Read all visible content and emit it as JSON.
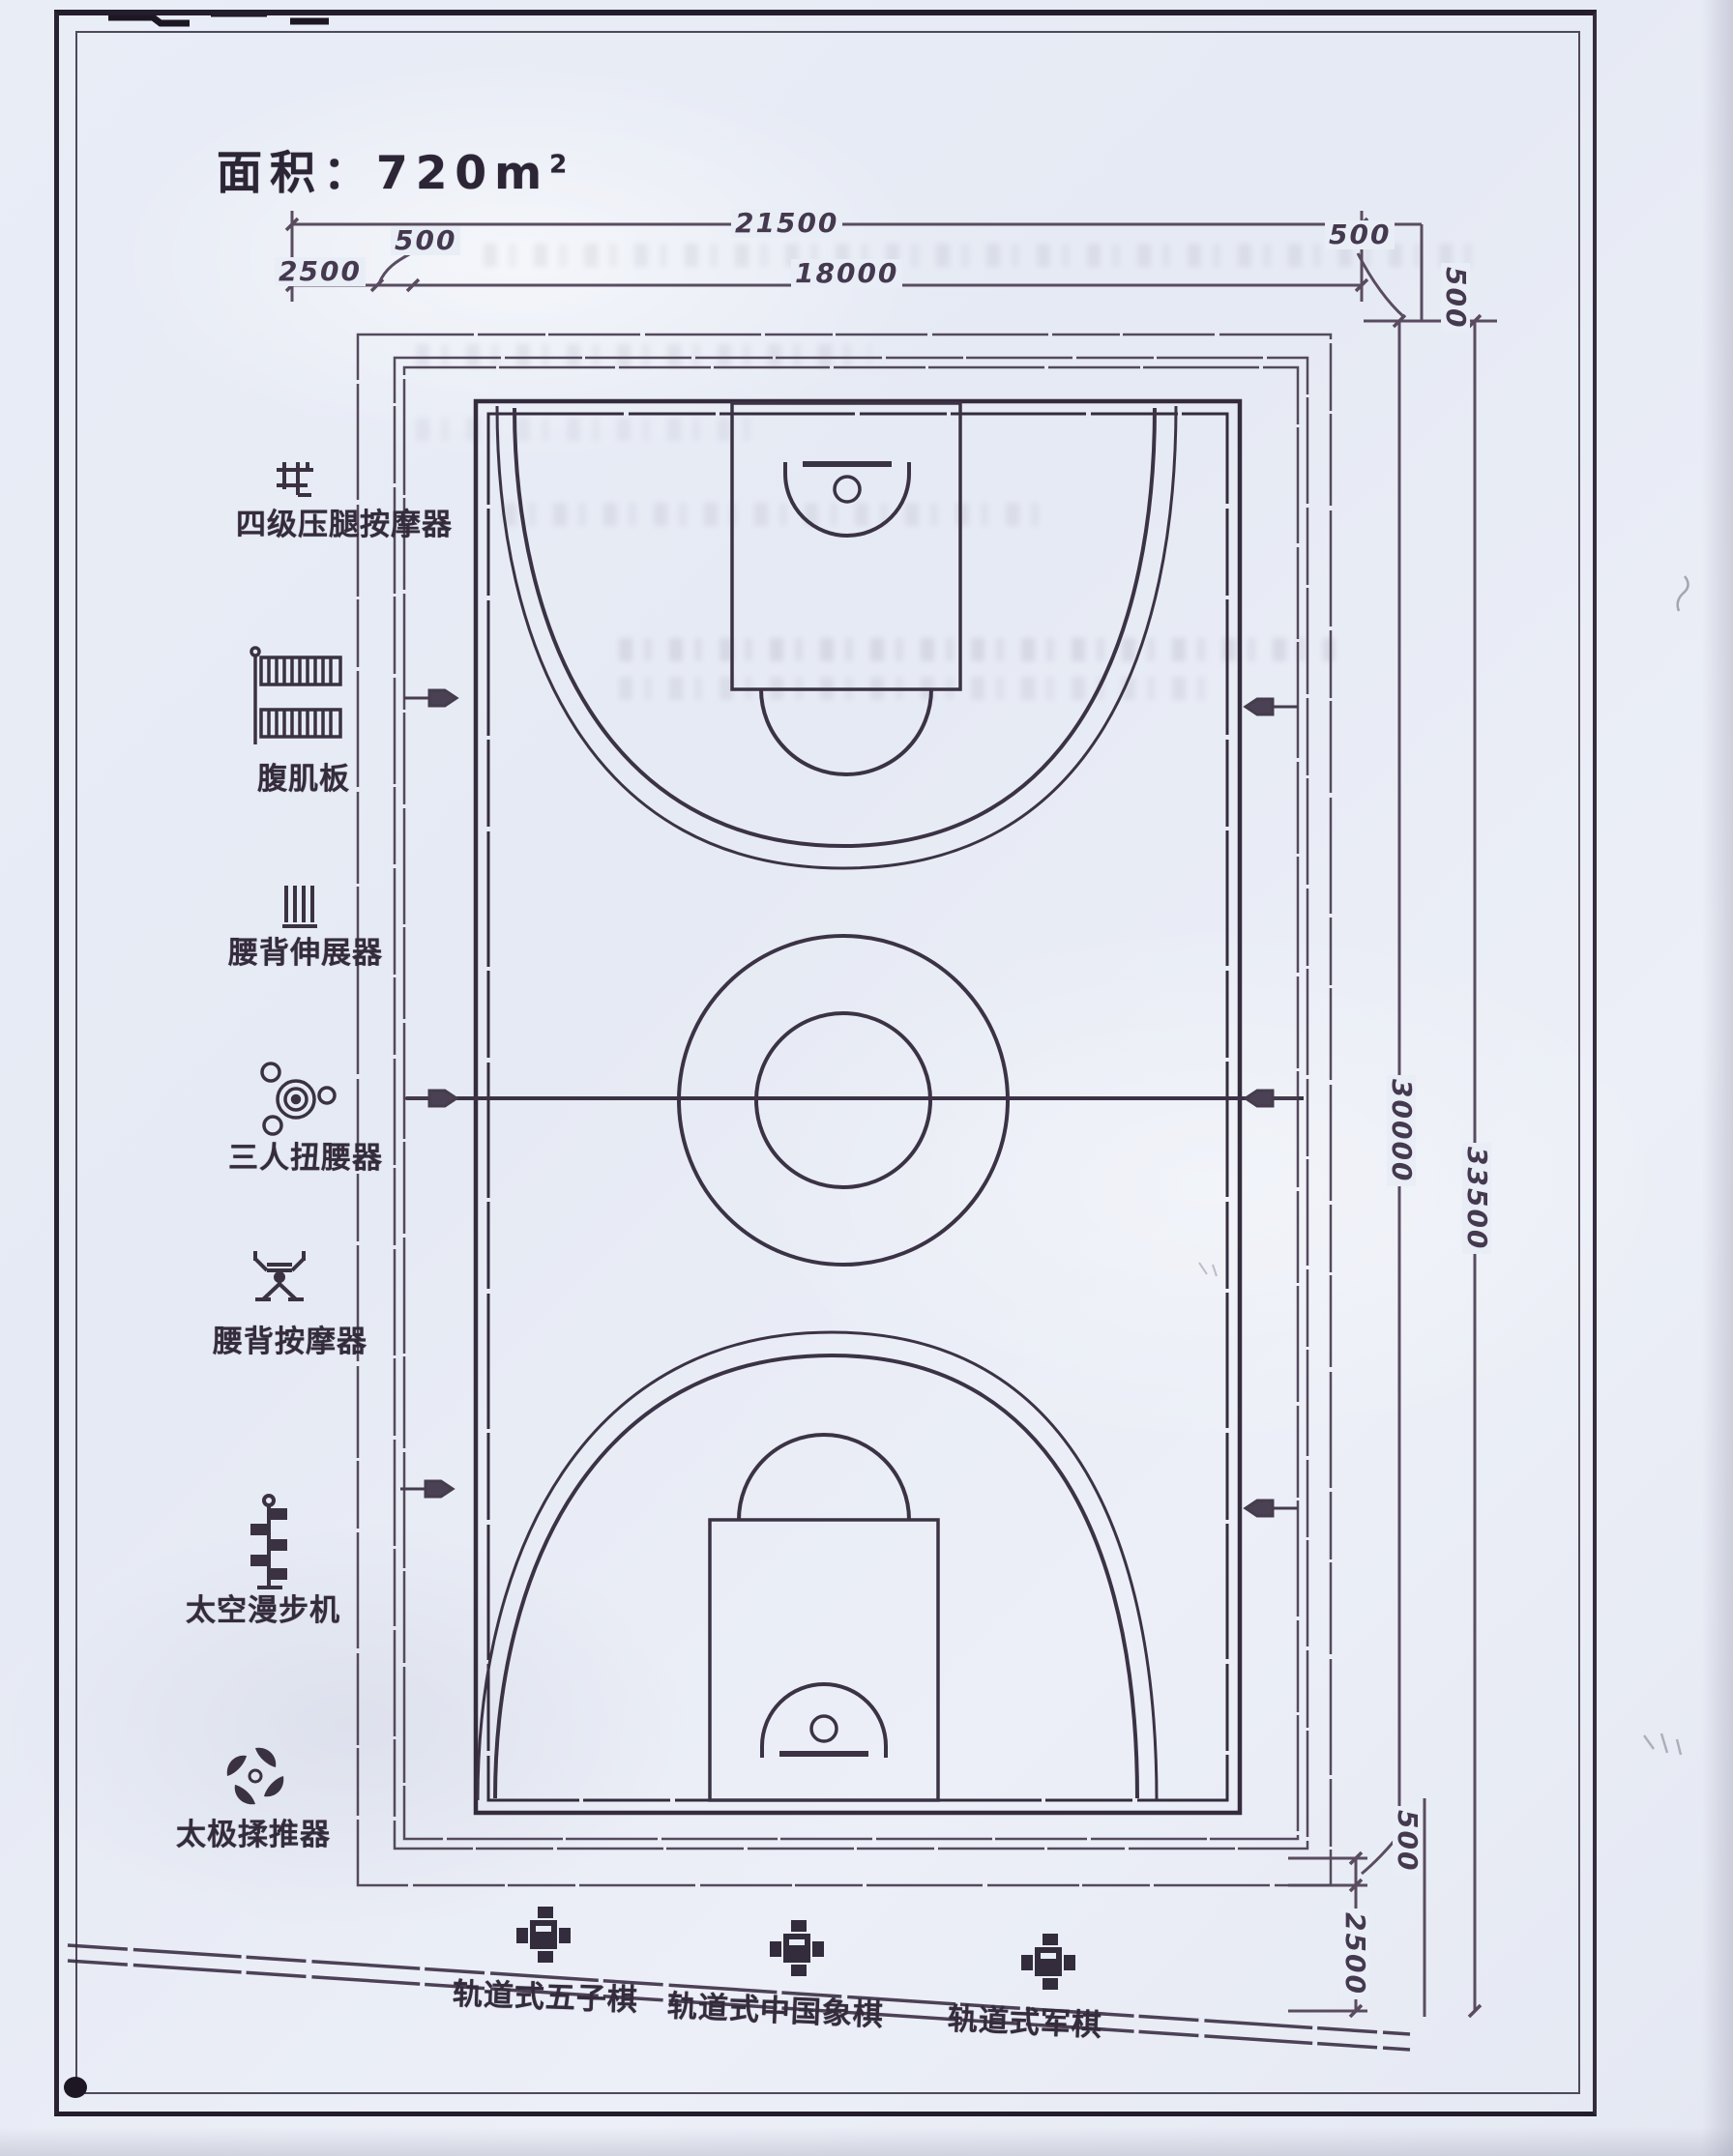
{
  "title": {
    "prefix": "面积：",
    "value": "720m",
    "sup": "2"
  },
  "dimensions": {
    "top_total": "21500",
    "left_offset": "2500",
    "left_small": "500",
    "inner_width": "18000",
    "right_small_h": "500",
    "right_small_v": "500",
    "inner_height": "30000",
    "total_height": "33500",
    "bottom_small": "500",
    "bottom_offset": "2500"
  },
  "equipment": [
    {
      "label": "四级压腿按摩器",
      "icon": "leg-press-rack-icon"
    },
    {
      "label": "腹肌板",
      "icon": "sit-up-board-icon"
    },
    {
      "label": "腰背伸展器",
      "icon": "back-stretcher-icon"
    },
    {
      "label": "三人扭腰器",
      "icon": "waist-twister-icon"
    },
    {
      "label": "腰背按摩器",
      "icon": "back-massager-icon"
    },
    {
      "label": "太空漫步机",
      "icon": "air-walker-icon"
    },
    {
      "label": "太极揉推器",
      "icon": "taiji-wheel-icon"
    }
  ],
  "chess_tables": [
    {
      "label": "轨道式五子棋",
      "icon": "chess-table-icon"
    },
    {
      "label": "轨道式中国象棋",
      "icon": "chess-table-icon"
    },
    {
      "label": "轨道式军棋",
      "icon": "chess-table-icon"
    }
  ],
  "colors": {
    "ink": "#453c4c",
    "ink_heavy": "#332c3c",
    "paper": "#e9edf6",
    "dim_ink": "#5a4c60"
  }
}
